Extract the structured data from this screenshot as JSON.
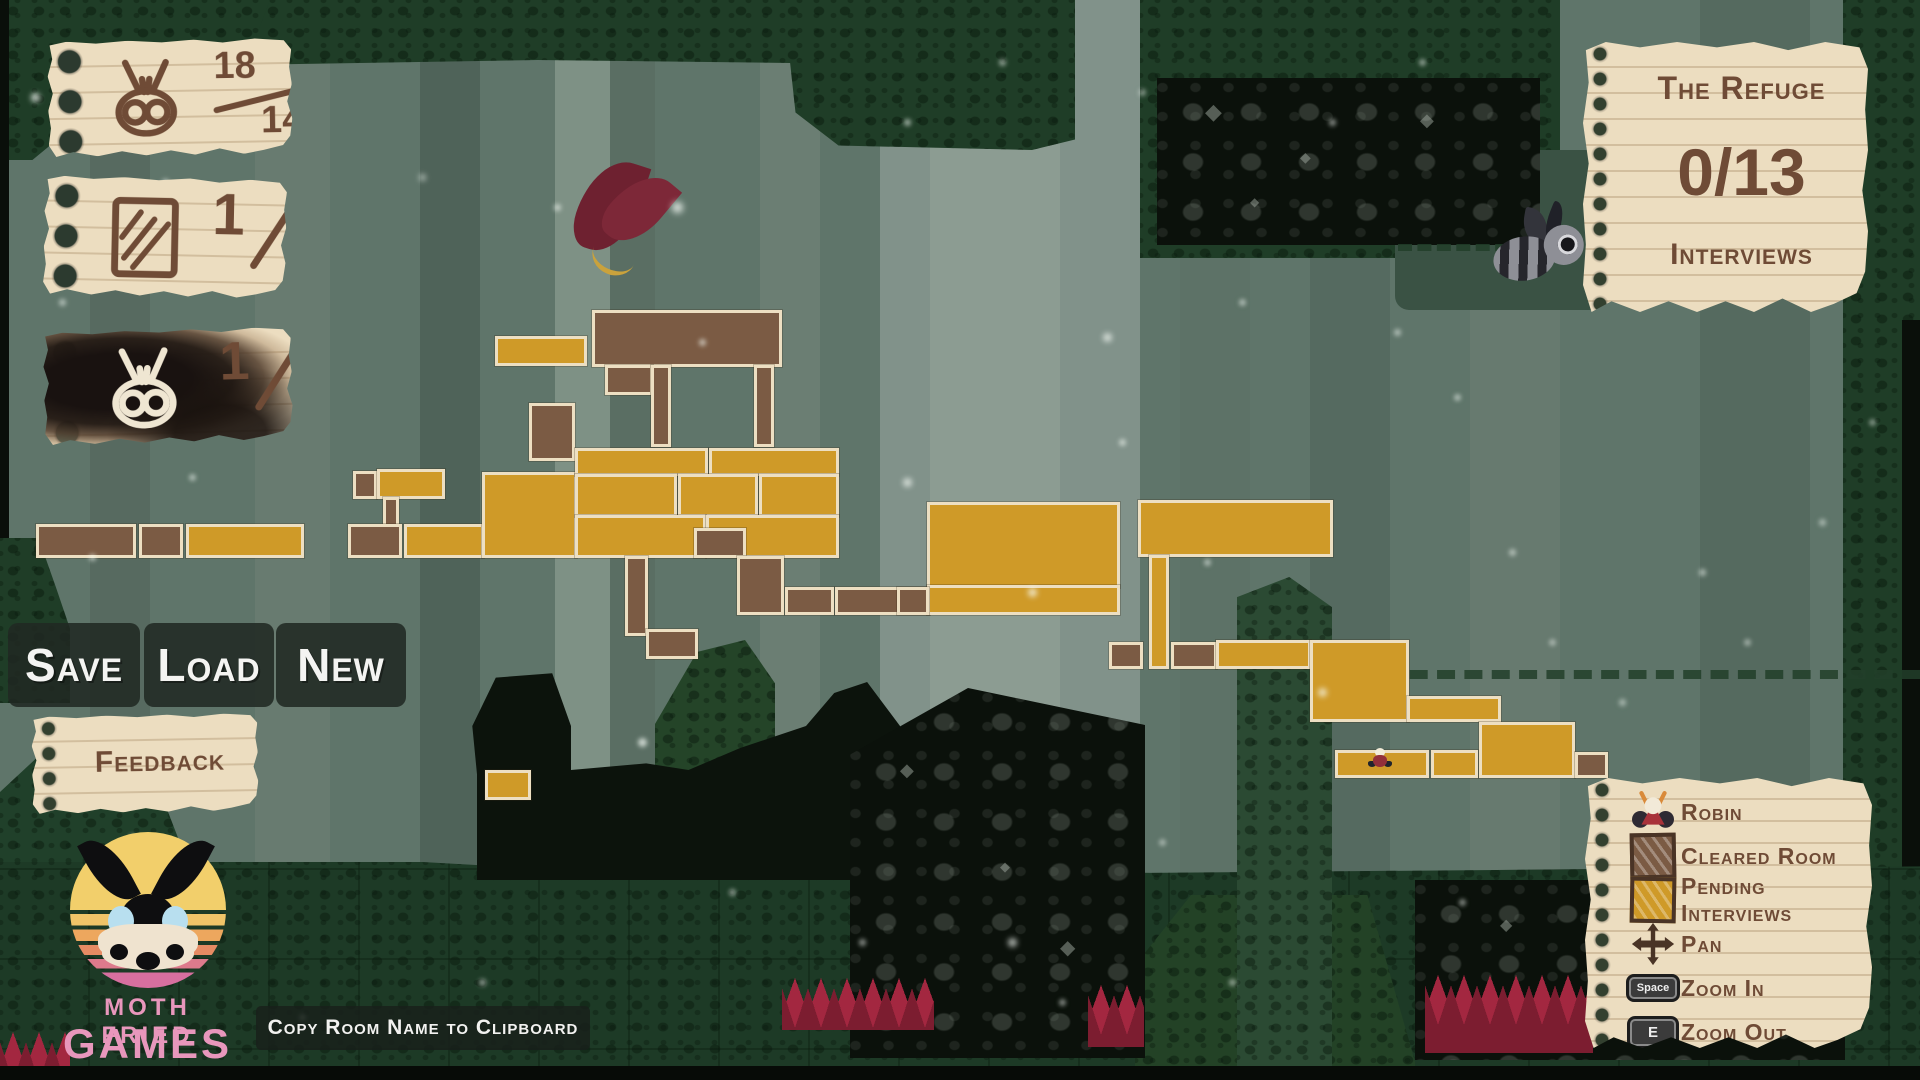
{
  "counters": [
    {
      "name": "moth-count",
      "num": "18",
      "den": "140"
    },
    {
      "name": "card-count",
      "num": "1",
      "den": "2"
    },
    {
      "name": "burned-moth-count",
      "num": "1",
      "den": "5"
    }
  ],
  "region_note": {
    "title": "The Refuge",
    "count": "0/13",
    "subtitle": "Interviews"
  },
  "toolbar": {
    "save_label": "Save",
    "load_label": "Load",
    "new_label": "New",
    "feedback_label": "Feedback"
  },
  "footer": {
    "copy_hint": "Copy Room Name to Clipboard"
  },
  "logo": {
    "line1": "MOTH FRIED",
    "line2": "GAMES"
  },
  "legend": {
    "items": [
      {
        "icon": "robin-icon",
        "label": "Robin"
      },
      {
        "icon": "cleared-room-swatch",
        "label": "Cleared Room"
      },
      {
        "icon": "pending-room-swatch",
        "label": "Pending Interviews"
      },
      {
        "icon": "pan-icon",
        "label": "Pan"
      },
      {
        "icon": "keycap",
        "key": "Space",
        "label": "Zoom In"
      },
      {
        "icon": "keycap",
        "key": "E",
        "label": "Zoom Out"
      }
    ]
  },
  "map": {
    "colors": {
      "gold": "#cf9a28",
      "brown": "#7b5b44",
      "outline": "#eddfc2"
    },
    "player_marker": {
      "x": 1368,
      "y": 748
    },
    "rooms": [
      {
        "x": 495,
        "y": 336,
        "w": 92,
        "h": 30,
        "c": "g"
      },
      {
        "x": 592,
        "y": 310,
        "w": 190,
        "h": 57,
        "c": "b"
      },
      {
        "x": 605,
        "y": 365,
        "w": 48,
        "h": 30,
        "c": "b"
      },
      {
        "x": 651,
        "y": 365,
        "w": 20,
        "h": 82,
        "c": "b"
      },
      {
        "x": 754,
        "y": 365,
        "w": 20,
        "h": 82,
        "c": "b"
      },
      {
        "x": 529,
        "y": 403,
        "w": 46,
        "h": 58,
        "c": "b"
      },
      {
        "x": 353,
        "y": 471,
        "w": 24,
        "h": 28,
        "c": "b"
      },
      {
        "x": 377,
        "y": 469,
        "w": 68,
        "h": 30,
        "c": "g"
      },
      {
        "x": 383,
        "y": 497,
        "w": 16,
        "h": 30,
        "c": "b"
      },
      {
        "x": 36,
        "y": 524,
        "w": 100,
        "h": 34,
        "c": "b"
      },
      {
        "x": 139,
        "y": 524,
        "w": 44,
        "h": 34,
        "c": "b"
      },
      {
        "x": 186,
        "y": 524,
        "w": 118,
        "h": 34,
        "c": "g"
      },
      {
        "x": 348,
        "y": 524,
        "w": 54,
        "h": 34,
        "c": "b"
      },
      {
        "x": 404,
        "y": 524,
        "w": 80,
        "h": 34,
        "c": "g"
      },
      {
        "x": 482,
        "y": 472,
        "w": 95,
        "h": 86,
        "c": "g"
      },
      {
        "x": 575,
        "y": 448,
        "w": 133,
        "h": 28,
        "c": "g"
      },
      {
        "x": 709,
        "y": 448,
        "w": 130,
        "h": 28,
        "c": "g"
      },
      {
        "x": 575,
        "y": 474,
        "w": 102,
        "h": 43,
        "c": "g"
      },
      {
        "x": 678,
        "y": 474,
        "w": 80,
        "h": 43,
        "c": "g"
      },
      {
        "x": 759,
        "y": 474,
        "w": 80,
        "h": 43,
        "c": "g"
      },
      {
        "x": 575,
        "y": 515,
        "w": 131,
        "h": 43,
        "c": "g"
      },
      {
        "x": 706,
        "y": 515,
        "w": 133,
        "h": 43,
        "c": "g"
      },
      {
        "x": 694,
        "y": 528,
        "w": 52,
        "h": 30,
        "c": "b"
      },
      {
        "x": 625,
        "y": 556,
        "w": 23,
        "h": 80,
        "c": "b"
      },
      {
        "x": 646,
        "y": 629,
        "w": 52,
        "h": 30,
        "c": "b"
      },
      {
        "x": 737,
        "y": 556,
        "w": 47,
        "h": 59,
        "c": "b"
      },
      {
        "x": 785,
        "y": 587,
        "w": 49,
        "h": 28,
        "c": "b"
      },
      {
        "x": 835,
        "y": 587,
        "w": 95,
        "h": 28,
        "c": "b"
      },
      {
        "x": 927,
        "y": 502,
        "w": 193,
        "h": 86,
        "c": "g"
      },
      {
        "x": 927,
        "y": 585,
        "w": 193,
        "h": 30,
        "c": "g"
      },
      {
        "x": 897,
        "y": 587,
        "w": 32,
        "h": 28,
        "c": "b"
      },
      {
        "x": 1138,
        "y": 500,
        "w": 195,
        "h": 57,
        "c": "g"
      },
      {
        "x": 1149,
        "y": 555,
        "w": 20,
        "h": 114,
        "c": "g"
      },
      {
        "x": 1109,
        "y": 642,
        "w": 34,
        "h": 27,
        "c": "b"
      },
      {
        "x": 1171,
        "y": 642,
        "w": 46,
        "h": 27,
        "c": "b"
      },
      {
        "x": 1216,
        "y": 640,
        "w": 95,
        "h": 29,
        "c": "g"
      },
      {
        "x": 1310,
        "y": 640,
        "w": 99,
        "h": 82,
        "c": "g"
      },
      {
        "x": 1407,
        "y": 696,
        "w": 94,
        "h": 26,
        "c": "g"
      },
      {
        "x": 1479,
        "y": 722,
        "w": 96,
        "h": 56,
        "c": "g"
      },
      {
        "x": 1335,
        "y": 750,
        "w": 94,
        "h": 28,
        "c": "g"
      },
      {
        "x": 1431,
        "y": 750,
        "w": 47,
        "h": 28,
        "c": "g"
      },
      {
        "x": 1575,
        "y": 752,
        "w": 33,
        "h": 26,
        "c": "b"
      },
      {
        "x": 485,
        "y": 770,
        "w": 46,
        "h": 30,
        "c": "g"
      }
    ]
  }
}
